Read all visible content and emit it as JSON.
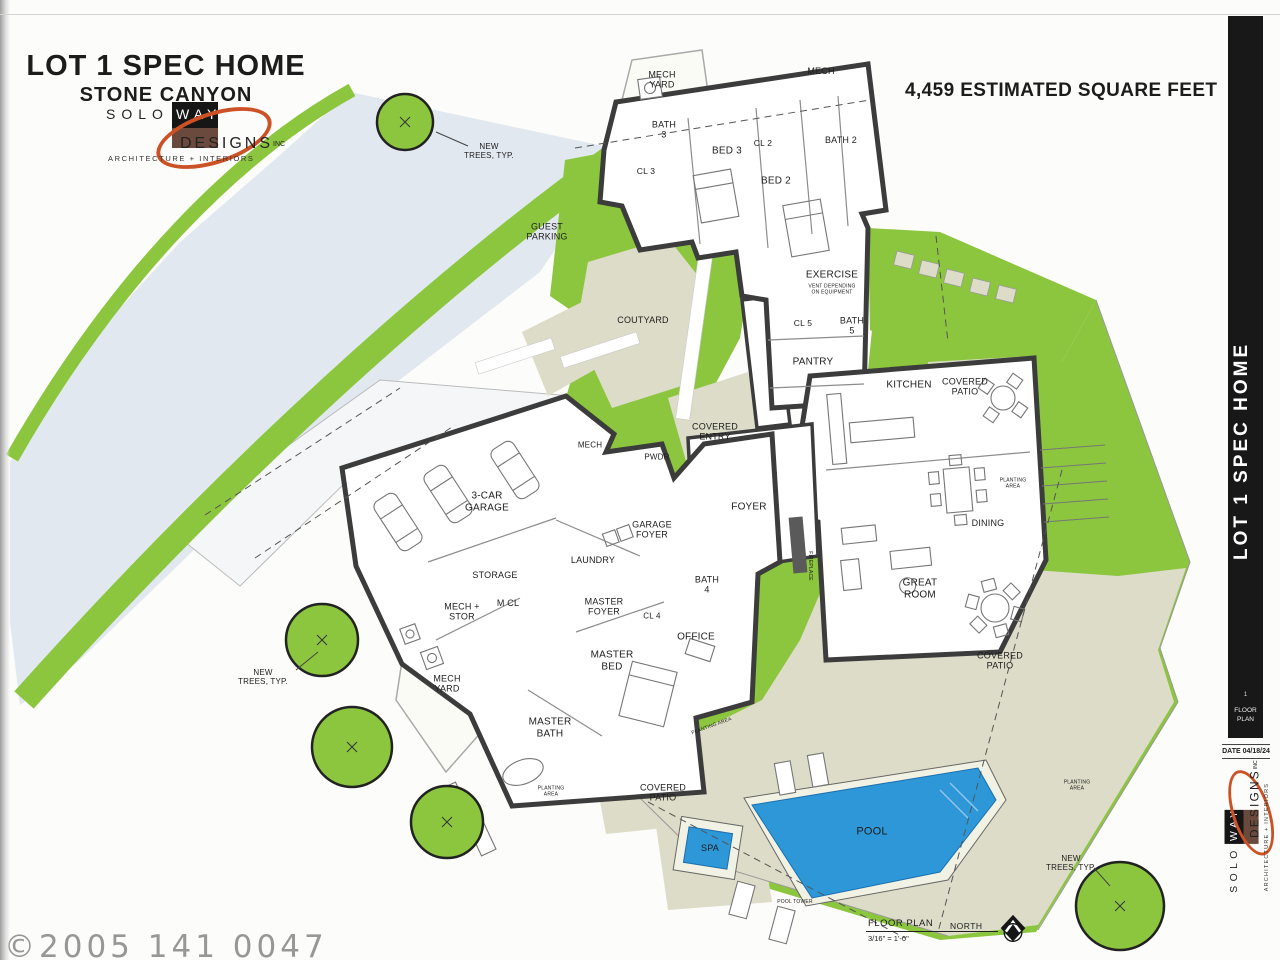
{
  "header": {
    "title": "LOT 1 SPEC HOME",
    "subtitle": "STONE CANYON",
    "sqft_note": "4,459 ESTIMATED SQUARE FEET"
  },
  "brand": {
    "solo": "SOLO",
    "way": "WAY",
    "designs": "DESIGNS",
    "inc": "INC",
    "tagline": "ARCHITECTURE + INTERIORS"
  },
  "sidebar": {
    "vertical_title": "LOT 1 SPEC HOME",
    "sheet_number": "1",
    "sheet_label": "FLOOR\nPLAN",
    "date_label": "DATE 04/18/24"
  },
  "footer": {
    "plan_title": "FLOOR PLAN",
    "plan_scale": "3/16\" = 1'-0\"",
    "north_label": "NORTH"
  },
  "watermark": "©2005 141 0047",
  "colors": {
    "landscape_green": "#8cc63e",
    "patio_beige": "#dcdcc8",
    "driveway_gray": "#e1e8f0",
    "pool_blue": "#2d97d8",
    "wall_dark": "#3c3c3c",
    "sidebar_black": "#181818",
    "logo_orange": "#cc5226"
  },
  "plan": {
    "labels": [
      {
        "text": "MECH\nYARD",
        "x": 662,
        "y": 80,
        "fs": 9
      },
      {
        "text": "MECH",
        "x": 821,
        "y": 71,
        "fs": 9
      },
      {
        "text": "BATH\n3",
        "x": 664,
        "y": 130,
        "fs": 9
      },
      {
        "text": "CL 3",
        "x": 646,
        "y": 172,
        "fs": 8.5
      },
      {
        "text": "BED 3",
        "x": 727,
        "y": 151,
        "fs": 10
      },
      {
        "text": "CL 2",
        "x": 763,
        "y": 144,
        "fs": 8.5
      },
      {
        "text": "BED 2",
        "x": 776,
        "y": 181,
        "fs": 10
      },
      {
        "text": "BATH 2",
        "x": 841,
        "y": 140,
        "fs": 9
      },
      {
        "text": "EXERCISE",
        "x": 832,
        "y": 275,
        "fs": 10
      },
      {
        "text": "VENT DEPENDING\nON EQUIPMENT",
        "x": 832,
        "y": 290,
        "fs": 5
      },
      {
        "text": "CL 5",
        "x": 803,
        "y": 324,
        "fs": 8.5
      },
      {
        "text": "BATH\n5",
        "x": 852,
        "y": 326,
        "fs": 9
      },
      {
        "text": "PANTRY",
        "x": 813,
        "y": 362,
        "fs": 10
      },
      {
        "text": "KITCHEN",
        "x": 909,
        "y": 385,
        "fs": 10
      },
      {
        "text": "COVERED\nPATIO",
        "x": 965,
        "y": 387,
        "fs": 9
      },
      {
        "text": "GUEST\nPARKING",
        "x": 547,
        "y": 232,
        "fs": 9
      },
      {
        "text": "COUTYARD",
        "x": 643,
        "y": 320,
        "fs": 9
      },
      {
        "text": "COVERED\nENTRY",
        "x": 715,
        "y": 432,
        "fs": 9
      },
      {
        "text": "MECH",
        "x": 590,
        "y": 445,
        "fs": 8
      },
      {
        "text": "PWDR",
        "x": 657,
        "y": 457,
        "fs": 8
      },
      {
        "text": "3-CAR\nGARAGE",
        "x": 487,
        "y": 502,
        "fs": 10
      },
      {
        "text": "GARAGE\nFOYER",
        "x": 652,
        "y": 530,
        "fs": 9
      },
      {
        "text": "LAUNDRY",
        "x": 593,
        "y": 560,
        "fs": 9
      },
      {
        "text": "STORAGE",
        "x": 495,
        "y": 575,
        "fs": 9
      },
      {
        "text": "MECH +\nSTOR",
        "x": 462,
        "y": 612,
        "fs": 9
      },
      {
        "text": "M CL",
        "x": 508,
        "y": 603,
        "fs": 9
      },
      {
        "text": "MASTER\nFOYER",
        "x": 604,
        "y": 607,
        "fs": 9
      },
      {
        "text": "CL 4",
        "x": 652,
        "y": 616,
        "fs": 8
      },
      {
        "text": "OFFICE",
        "x": 696,
        "y": 637,
        "fs": 10
      },
      {
        "text": "BATH\n4",
        "x": 707,
        "y": 585,
        "fs": 9
      },
      {
        "text": "FOYER",
        "x": 749,
        "y": 507,
        "fs": 10
      },
      {
        "text": "DINING",
        "x": 988,
        "y": 523,
        "fs": 9
      },
      {
        "text": "GREAT\nROOM",
        "x": 920,
        "y": 589,
        "fs": 10
      },
      {
        "text": "MASTER\nBED",
        "x": 612,
        "y": 661,
        "fs": 10
      },
      {
        "text": "MASTER\nBATH",
        "x": 550,
        "y": 728,
        "fs": 10
      },
      {
        "text": "MECH\nYARD",
        "x": 447,
        "y": 684,
        "fs": 9
      },
      {
        "text": "COVERED\nPATIO",
        "x": 1000,
        "y": 661,
        "fs": 9
      },
      {
        "text": "COVERED\nPATIO",
        "x": 663,
        "y": 793,
        "fs": 9
      },
      {
        "text": "SPA",
        "x": 710,
        "y": 848,
        "fs": 9
      },
      {
        "text": "POOL",
        "x": 872,
        "y": 832,
        "fs": 11
      },
      {
        "text": "NEW\nTREES, TYP.",
        "x": 489,
        "y": 151,
        "fs": 8
      },
      {
        "text": "NEW\nTREES, TYP.",
        "x": 263,
        "y": 677,
        "fs": 8
      },
      {
        "text": "NEW\nTREES, TYP.",
        "x": 1071,
        "y": 863,
        "fs": 8
      },
      {
        "text": "PLANTING\nAREA",
        "x": 1013,
        "y": 484,
        "fs": 5
      },
      {
        "text": "PLANTING\nAREA",
        "x": 551,
        "y": 792,
        "fs": 5
      },
      {
        "text": "PLANTING\nAREA",
        "x": 1077,
        "y": 786,
        "fs": 5
      },
      {
        "text": "PLANTING AREA",
        "x": 712,
        "y": 727,
        "fs": 5,
        "rot": -20
      },
      {
        "text": "FIREPLACE",
        "x": 809,
        "y": 566,
        "fs": 5,
        "rot": 90
      },
      {
        "text": "POOL TOWER",
        "x": 795,
        "y": 903,
        "fs": 5
      }
    ]
  }
}
